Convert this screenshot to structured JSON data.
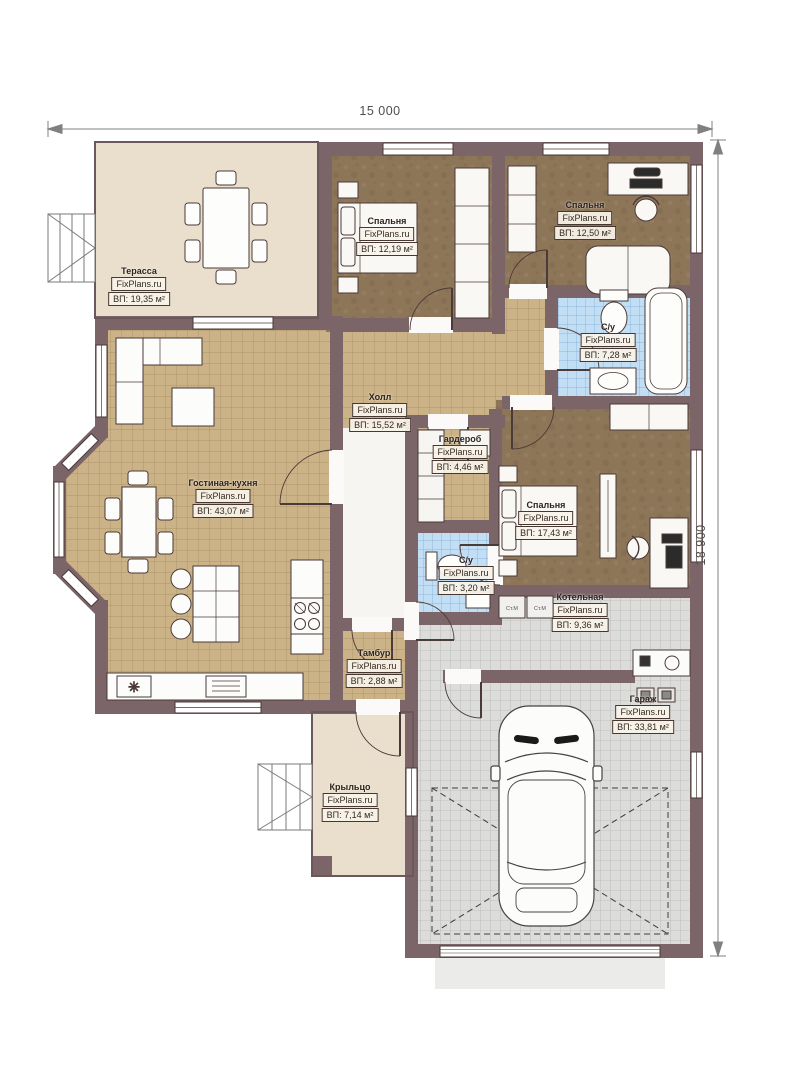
{
  "brand": "FixPlans.ru",
  "dimensions": {
    "width_label": "15 000",
    "height_label": "18 900"
  },
  "rooms": [
    {
      "name": "Терасса",
      "brand": "FixPlans.ru",
      "area": "ВП: 19,35 м²"
    },
    {
      "name": "Спальня",
      "brand": "FixPlans.ru",
      "area": "ВП: 12,19 м²"
    },
    {
      "name": "Спальня",
      "brand": "FixPlans.ru",
      "area": "ВП: 12,50 м²"
    },
    {
      "name": "С/у",
      "brand": "FixPlans.ru",
      "area": "ВП: 7,28 м²"
    },
    {
      "name": "Холл",
      "brand": "FixPlans.ru",
      "area": "ВП: 15,52 м²"
    },
    {
      "name": "Гардероб",
      "brand": "FixPlans.ru",
      "area": "ВП: 4,46 м²"
    },
    {
      "name": "Спальня",
      "brand": "FixPlans.ru",
      "area": "ВП: 17,43 м²"
    },
    {
      "name": "С/у",
      "brand": "FixPlans.ru",
      "area": "ВП: 3,20 м²"
    },
    {
      "name": "Гостиная-кухня",
      "brand": "FixPlans.ru",
      "area": "ВП: 43,07 м²"
    },
    {
      "name": "Тамбур",
      "brand": "FixPlans.ru",
      "area": "ВП: 2,88 м²"
    },
    {
      "name": "Котельная",
      "brand": "FixPlans.ru",
      "area": "ВП: 9,36 м²"
    },
    {
      "name": "Гараж",
      "brand": "FixPlans.ru",
      "area": "ВП: 33,81 м²"
    },
    {
      "name": "Крыльцо",
      "brand": "FixPlans.ru",
      "area": "ВП: 7,14 м²"
    }
  ],
  "appliances": {
    "washer1": "Ст.М",
    "washer2": "Ст.М"
  },
  "colors": {
    "wall": "#7b6568",
    "bedroom_floor": "#8d7557",
    "tile_floor": "#cbb287",
    "bath_floor": "#c2def5",
    "garage_floor": "#dcdcda",
    "terrace_floor": "#eadfcd"
  }
}
